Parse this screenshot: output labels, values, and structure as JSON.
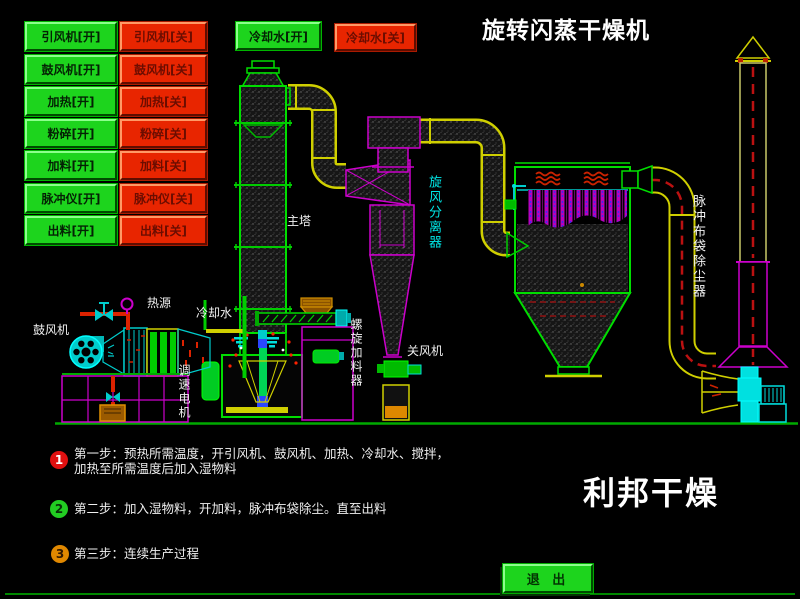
{
  "header": {
    "title": "旋转闪蒸干燥机"
  },
  "panel": {
    "on_buttons": [
      "引风机[开]",
      "鼓风机[开]",
      "加热[开]",
      "粉碎[开]",
      "加料[开]",
      "脉冲仪[开]",
      "出料[开]"
    ],
    "off_buttons": [
      "引风机[关]",
      "鼓风机[关]",
      "加热[关]",
      "粉碎[关]",
      "加料[关]",
      "脉冲仪[关]",
      "出料[关]"
    ],
    "cooling_on": "冷却水[开]",
    "cooling_off": "冷却水[关]"
  },
  "diagram_labels": {
    "main_tower": "主塔",
    "cyclone": "旋风分离器",
    "bag_filter": "脉冲布袋除尘器",
    "blower": "鼓风机",
    "heat_source": "热源",
    "cooling_water": "冷却水",
    "speed_motor": "调速电机",
    "screw_feeder": "螺旋加料器",
    "rotary_valve": "关风机"
  },
  "steps": {
    "n1": "1",
    "s1a": "第一步：预热所需温度，开引风机、鼓风机、加热、冷却水、搅拌，",
    "s1b": "加热至所需温度后加入湿物料",
    "n2": "2",
    "s2": "第二步：加入湿物料，开加料，脉冲布袋除尘。直至出料",
    "n3": "3",
    "s3": "第三步：连续生产过程"
  },
  "footer": {
    "brand": "利邦干燥",
    "exit": "退 出"
  },
  "colors": {
    "button_green": "#1dd41d",
    "button_red": "#e82500",
    "line_green": "#00dd00",
    "line_magenta": "#cc00cc",
    "line_yellow": "#cfcf00",
    "line_cyan": "#00cccc",
    "flow_red": "#cc1111",
    "step1_badge": "#e01010",
    "step2_badge": "#22cc22",
    "step3_badge": "#e08800"
  }
}
